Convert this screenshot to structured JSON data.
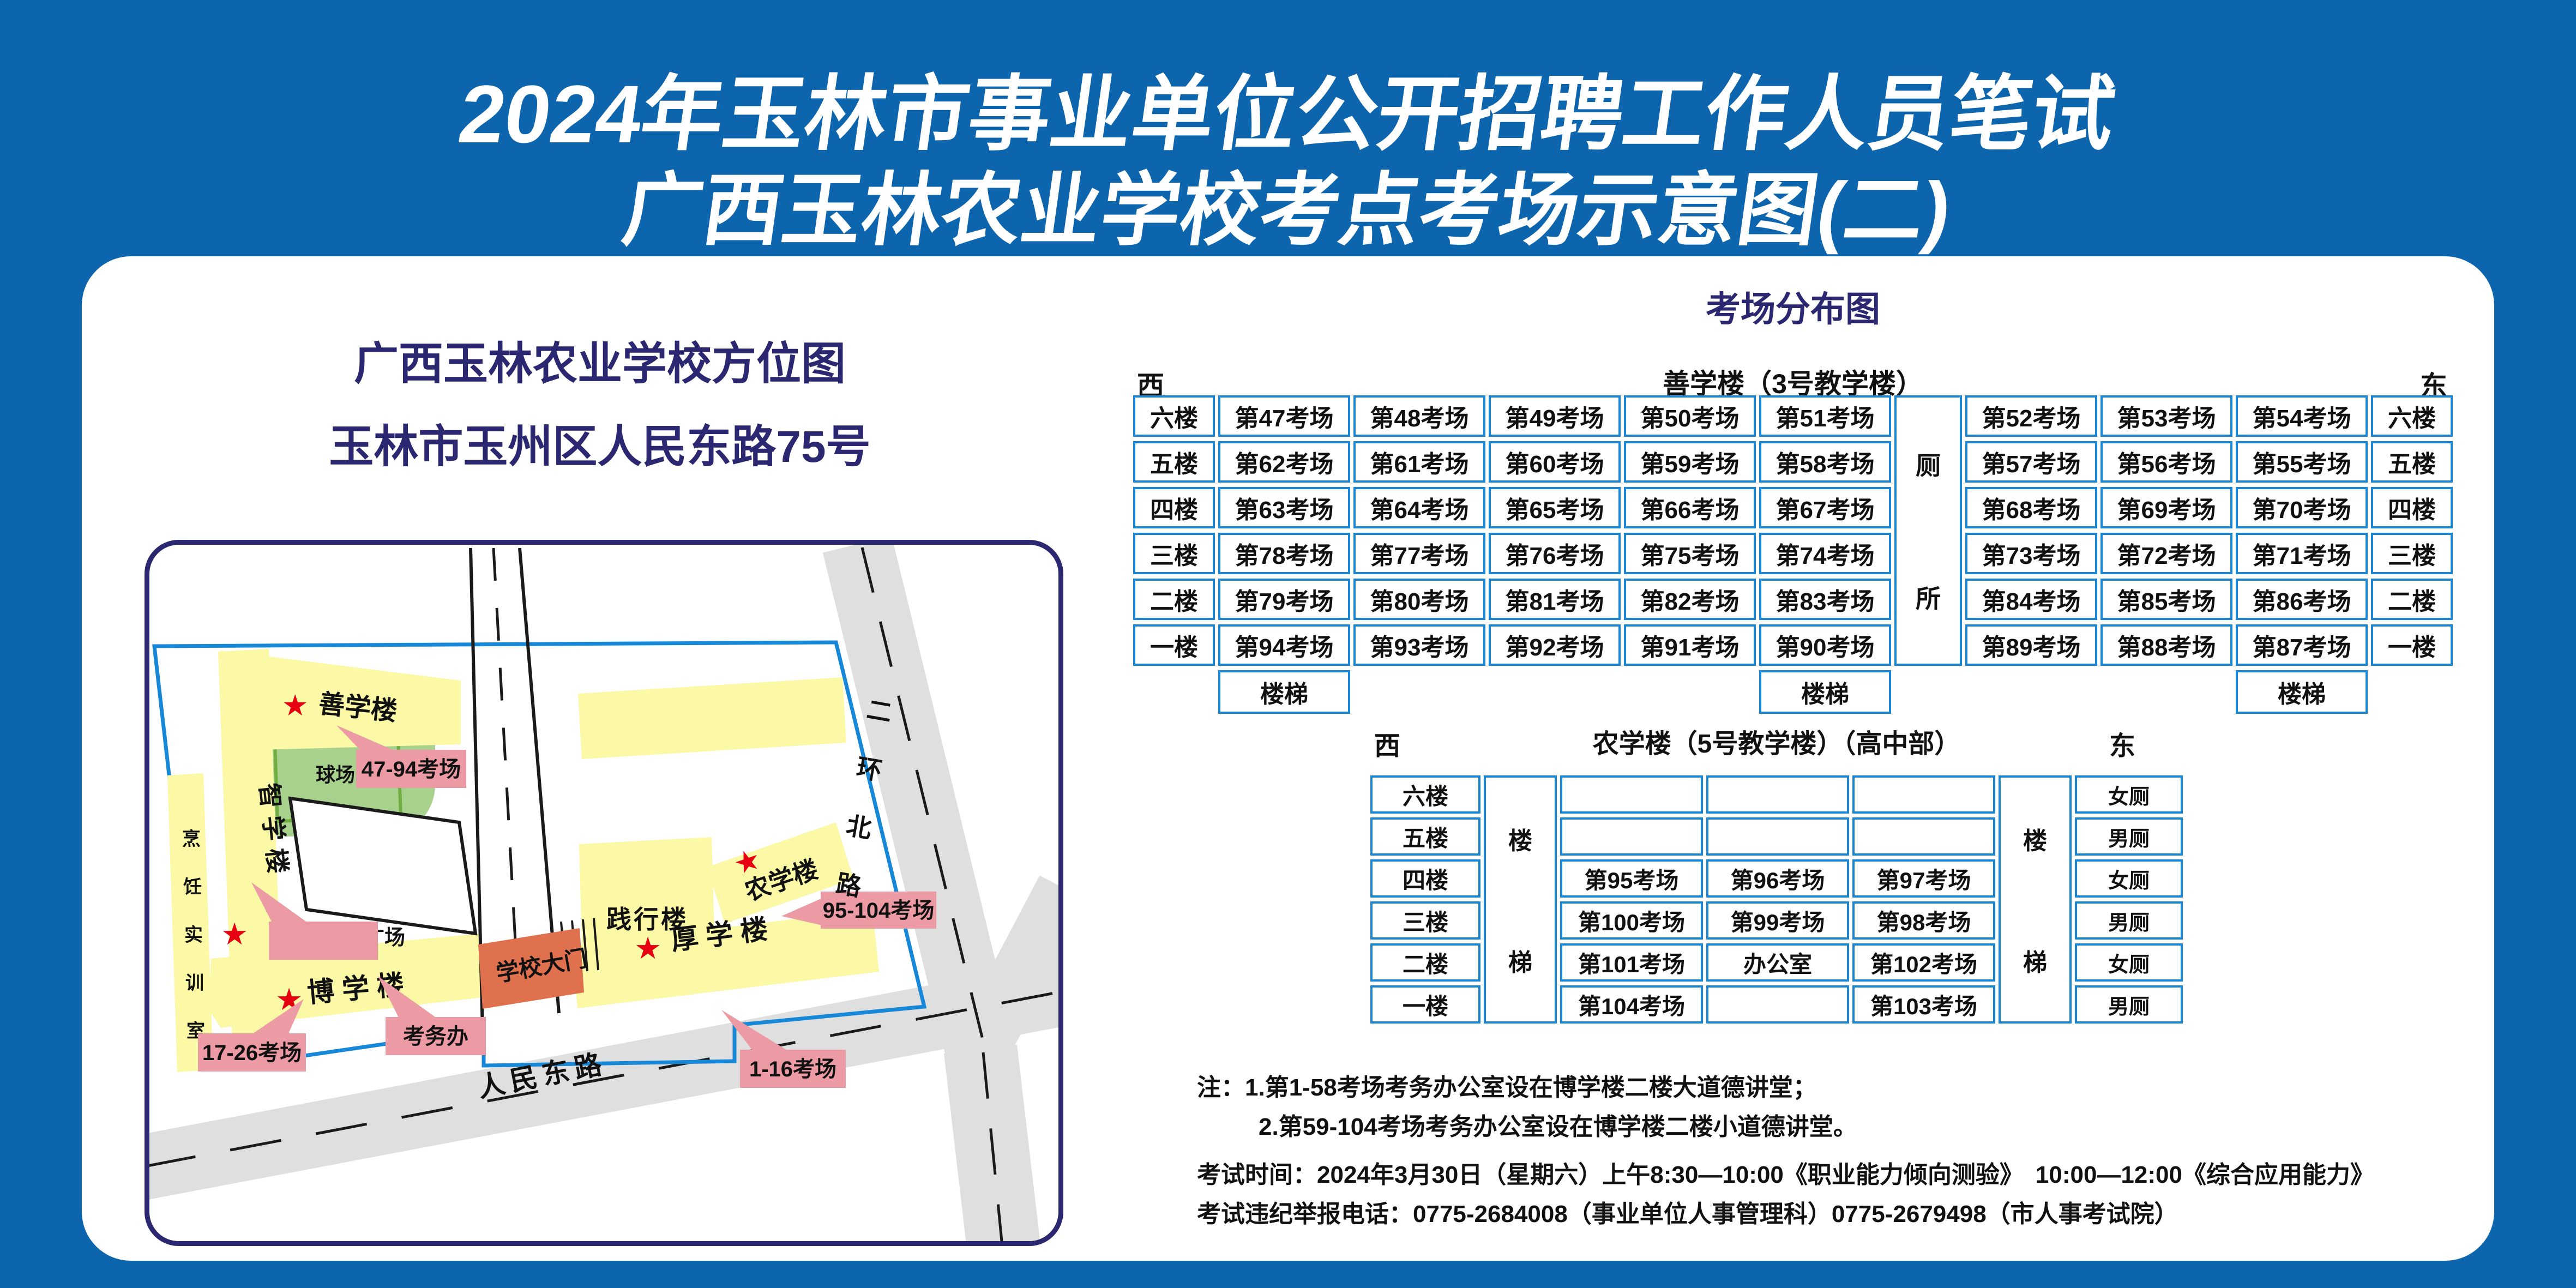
{
  "page": {
    "title_line1": "2024年玉林市事业单位公开招聘工作人员笔试",
    "title_line2": "广西玉林农业学校考点考场示意图(二)"
  },
  "map": {
    "title_line1": "广西玉林农业学校方位图",
    "title_line2": "玉林市玉州区人民东路75号",
    "labels": {
      "qiuchang": "球场",
      "shanxuelou": "善学楼",
      "tag_47_94": "47-94考场",
      "zhixuelou": "智学楼",
      "pengren_chars": [
        "烹",
        "饪",
        "实",
        "训",
        "室"
      ],
      "yangguang": "阳光广场",
      "jianxinglou": "践行楼",
      "nongxuelou": "农学楼",
      "tag_95_104": "95-104考场",
      "houxuelou": "厚 学 楼",
      "tag_1_16": "1-16考场",
      "boxuelou": "博 学 楼",
      "tag_17_26": "17-26考场",
      "kaowuban": "考务办",
      "xuexiaodamen": "学校大门",
      "renmindonglu": "人民东路",
      "erhuan_chars": [
        "二",
        "环",
        "北",
        "路"
      ],
      "star": "★"
    }
  },
  "distribution": {
    "title": "考场分布图",
    "shanxue": {
      "west": "西",
      "east": "东",
      "building": "善学楼（3号教学楼）",
      "floors": [
        "六楼",
        "五楼",
        "四楼",
        "三楼",
        "二楼",
        "一楼"
      ],
      "left_rooms": [
        [
          "第47考场",
          "第48考场",
          "第49考场",
          "第50考场",
          "第51考场"
        ],
        [
          "第62考场",
          "第61考场",
          "第60考场",
          "第59考场",
          "第58考场"
        ],
        [
          "第63考场",
          "第64考场",
          "第65考场",
          "第66考场",
          "第67考场"
        ],
        [
          "第78考场",
          "第77考场",
          "第76考场",
          "第75考场",
          "第74考场"
        ],
        [
          "第79考场",
          "第80考场",
          "第81考场",
          "第82考场",
          "第83考场"
        ],
        [
          "第94考场",
          "第93考场",
          "第92考场",
          "第91考场",
          "第90考场"
        ]
      ],
      "right_rooms": [
        [
          "第52考场",
          "第53考场",
          "第54考场"
        ],
        [
          "第57考场",
          "第56考场",
          "第55考场"
        ],
        [
          "第68考场",
          "第69考场",
          "第70考场"
        ],
        [
          "第73考场",
          "第72考场",
          "第71考场"
        ],
        [
          "第84考场",
          "第85考场",
          "第86考场"
        ],
        [
          "第89考场",
          "第88考场",
          "第87考场"
        ]
      ],
      "toilet_chars": [
        "厕",
        "所"
      ],
      "stairs_word": "楼梯"
    },
    "nongxue": {
      "west": "西",
      "east": "东",
      "building": "农学楼（5号教学楼）（高中部）",
      "floors": [
        "六楼",
        "五楼",
        "四楼",
        "三楼",
        "二楼",
        "一楼"
      ],
      "rooms": [
        [
          "",
          "",
          ""
        ],
        [
          "",
          "",
          ""
        ],
        [
          "第95考场",
          "第96考场",
          "第97考场"
        ],
        [
          "第100考场",
          "第99考场",
          "第98考场"
        ],
        [
          "第101考场",
          "办公室",
          "第102考场"
        ],
        [
          "第104考场",
          "",
          "第103考场"
        ]
      ],
      "toilets": [
        "女厕",
        "男厕",
        "女厕",
        "男厕",
        "女厕",
        "男厕"
      ],
      "stairs_chars": [
        "楼",
        "梯"
      ]
    }
  },
  "notes": {
    "line1": "注：1.第1-58考场考务办公室设在博学楼二楼大道德讲堂；",
    "line2": "2.第59-104考场考务办公室设在博学楼二楼小道德讲堂。",
    "line3": "考试时间：2024年3月30日（星期六）上午8:30—10:00《职业能力倾向测验》　10:00—12:00《综合应用能力》",
    "line4": "考试违纪举报电话：0775-2684008（事业单位人事管理科）0775-2679498（市人事考试院）"
  }
}
